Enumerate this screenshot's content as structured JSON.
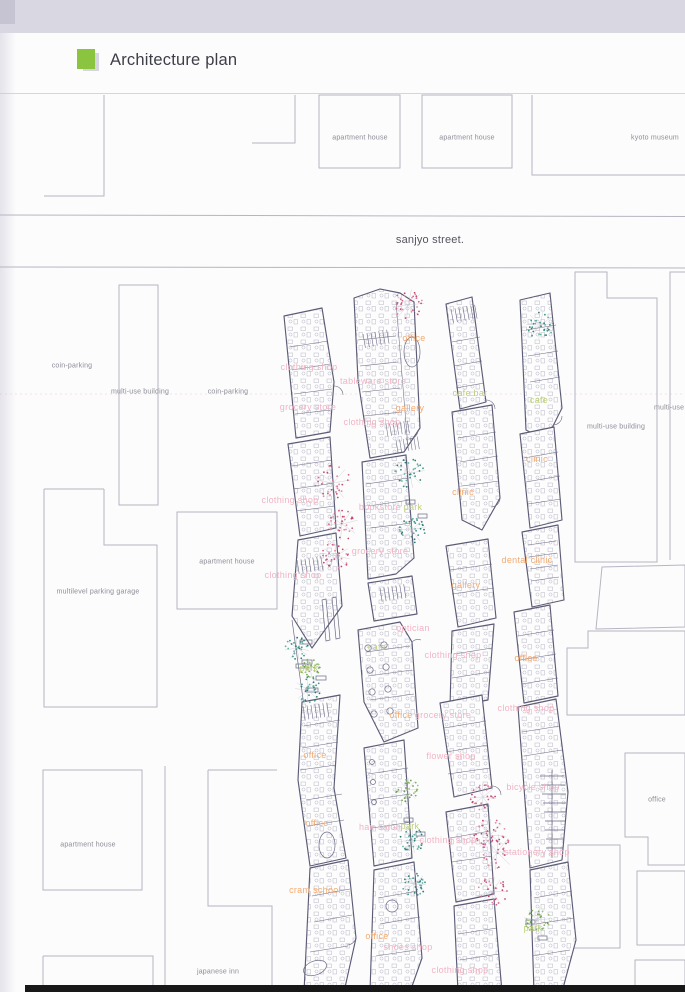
{
  "page": {
    "title": "Architecture plan"
  },
  "street": {
    "label": "sanjyo street."
  },
  "colors": {
    "logo_green": "#8bc53f",
    "top_band": "#d9d7e1",
    "bottom_bar": "#181818",
    "outline_gray": "#b7b5c1",
    "plan_line": "#5c5c76",
    "label_pink": "#f2b4c4",
    "label_orange": "#f2ab72",
    "label_green": "#bcd07c",
    "label_gray": "#8c8c96",
    "trees": {
      "pink": [
        "#d4648a",
        "#e08aa4",
        "#c04a6e"
      ],
      "teal": [
        "#3f9488",
        "#68b0a4",
        "#2f7a6e"
      ],
      "green": [
        "#7fae5f",
        "#9cc47e",
        "#6a9c52"
      ]
    }
  },
  "plan": {
    "labels": [
      {
        "text": "sanjyo street.",
        "x": 430,
        "y": 240,
        "c": "street"
      },
      {
        "text": "apartment house",
        "x": 360,
        "y": 138,
        "c": "gray"
      },
      {
        "text": "apartment house",
        "x": 467,
        "y": 138,
        "c": "gray"
      },
      {
        "text": "kyoto museum",
        "x": 655,
        "y": 138,
        "c": "gray"
      },
      {
        "text": "coin-parking",
        "x": 72,
        "y": 366,
        "c": "gray"
      },
      {
        "text": "multi-use building",
        "x": 140,
        "y": 392,
        "c": "gray"
      },
      {
        "text": "coin-parking",
        "x": 228,
        "y": 392,
        "c": "gray"
      },
      {
        "text": "apartment house",
        "x": 227,
        "y": 562,
        "c": "gray"
      },
      {
        "text": "multilevel parking garage",
        "x": 98,
        "y": 592,
        "c": "gray"
      },
      {
        "text": "apartment house",
        "x": 88,
        "y": 845,
        "c": "gray"
      },
      {
        "text": "japanese inn",
        "x": 218,
        "y": 972,
        "c": "gray"
      },
      {
        "text": "multi-use building",
        "x": 616,
        "y": 427,
        "c": "gray"
      },
      {
        "text": "multi-use building",
        "x": 683,
        "y": 408,
        "c": "gray"
      },
      {
        "text": "office",
        "x": 657,
        "y": 800,
        "c": "gray"
      },
      {
        "text": "office",
        "x": 414,
        "y": 338,
        "c": "orange"
      },
      {
        "text": "gallery",
        "x": 410,
        "y": 408,
        "c": "orange"
      },
      {
        "text": "clinic",
        "x": 537,
        "y": 459,
        "c": "orange"
      },
      {
        "text": "clinic",
        "x": 463,
        "y": 492,
        "c": "orange"
      },
      {
        "text": "dental clinic",
        "x": 527,
        "y": 560,
        "c": "orange"
      },
      {
        "text": "gallery",
        "x": 466,
        "y": 585,
        "c": "orange"
      },
      {
        "text": "office",
        "x": 526,
        "y": 658,
        "c": "orange"
      },
      {
        "text": "office",
        "x": 401,
        "y": 715,
        "c": "orange"
      },
      {
        "text": "office",
        "x": 315,
        "y": 755,
        "c": "orange"
      },
      {
        "text": "office",
        "x": 317,
        "y": 823,
        "c": "orange"
      },
      {
        "text": "cram school",
        "x": 315,
        "y": 890,
        "c": "orange"
      },
      {
        "text": "office",
        "x": 377,
        "y": 936,
        "c": "orange"
      },
      {
        "text": "clothing shop",
        "x": 309,
        "y": 367,
        "c": "pink"
      },
      {
        "text": "tableware store",
        "x": 373,
        "y": 381,
        "c": "pink"
      },
      {
        "text": "grocery store",
        "x": 308,
        "y": 407,
        "c": "pink"
      },
      {
        "text": "clothing shop",
        "x": 372,
        "y": 422,
        "c": "pink"
      },
      {
        "text": "clothing shop",
        "x": 290,
        "y": 500,
        "c": "pink"
      },
      {
        "text": "bookstore",
        "x": 380,
        "y": 507,
        "c": "pink"
      },
      {
        "text": "grocery store",
        "x": 380,
        "y": 551,
        "c": "pink"
      },
      {
        "text": "clothing shop",
        "x": 293,
        "y": 575,
        "c": "pink"
      },
      {
        "text": "optician",
        "x": 413,
        "y": 628,
        "c": "pink"
      },
      {
        "text": "clothing shop",
        "x": 453,
        "y": 655,
        "c": "pink"
      },
      {
        "text": "clothing shop",
        "x": 526,
        "y": 708,
        "c": "pink"
      },
      {
        "text": "grocery store",
        "x": 443,
        "y": 715,
        "c": "pink"
      },
      {
        "text": "flower shop",
        "x": 451,
        "y": 756,
        "c": "pink"
      },
      {
        "text": "bicycle shop",
        "x": 533,
        "y": 787,
        "c": "pink"
      },
      {
        "text": "hair salon",
        "x": 380,
        "y": 827,
        "c": "pink"
      },
      {
        "text": "clothing shop",
        "x": 448,
        "y": 840,
        "c": "pink"
      },
      {
        "text": "stationery shop",
        "x": 537,
        "y": 852,
        "c": "pink"
      },
      {
        "text": "shoes shop",
        "x": 408,
        "y": 947,
        "c": "pink"
      },
      {
        "text": "clothing shop",
        "x": 460,
        "y": 970,
        "c": "pink"
      },
      {
        "text": "cafe bar",
        "x": 470,
        "y": 393,
        "c": "green"
      },
      {
        "text": "cafe",
        "x": 539,
        "y": 400,
        "c": "green"
      },
      {
        "text": "park",
        "x": 413,
        "y": 507,
        "c": "green"
      },
      {
        "text": "cafe",
        "x": 377,
        "y": 647,
        "c": "green"
      },
      {
        "text": "park",
        "x": 309,
        "y": 668,
        "c": "green"
      },
      {
        "text": "park",
        "x": 410,
        "y": 826,
        "c": "green"
      },
      {
        "text": "park",
        "x": 533,
        "y": 928,
        "c": "green"
      }
    ],
    "trees": [
      {
        "x": 408,
        "y": 305,
        "r": 16,
        "c": "pink"
      },
      {
        "x": 333,
        "y": 483,
        "r": 18,
        "c": "pink"
      },
      {
        "x": 342,
        "y": 524,
        "r": 16,
        "c": "pink"
      },
      {
        "x": 336,
        "y": 556,
        "r": 14,
        "c": "pink"
      },
      {
        "x": 483,
        "y": 797,
        "r": 13,
        "c": "pink"
      },
      {
        "x": 490,
        "y": 835,
        "r": 16,
        "c": "pink"
      },
      {
        "x": 497,
        "y": 852,
        "r": 18,
        "c": "pink"
      },
      {
        "x": 492,
        "y": 892,
        "r": 15,
        "c": "pink"
      },
      {
        "x": 540,
        "y": 325,
        "r": 14,
        "c": "teal"
      },
      {
        "x": 410,
        "y": 473,
        "r": 15,
        "c": "teal"
      },
      {
        "x": 412,
        "y": 530,
        "r": 14,
        "c": "teal"
      },
      {
        "x": 297,
        "y": 648,
        "r": 12,
        "c": "teal"
      },
      {
        "x": 308,
        "y": 690,
        "r": 13,
        "c": "teal"
      },
      {
        "x": 412,
        "y": 840,
        "r": 13,
        "c": "teal"
      },
      {
        "x": 414,
        "y": 884,
        "r": 12,
        "c": "teal"
      },
      {
        "x": 407,
        "y": 790,
        "r": 12,
        "c": "green"
      },
      {
        "x": 537,
        "y": 920,
        "r": 13,
        "c": "green"
      },
      {
        "x": 310,
        "y": 668,
        "r": 10,
        "c": "green"
      }
    ]
  }
}
